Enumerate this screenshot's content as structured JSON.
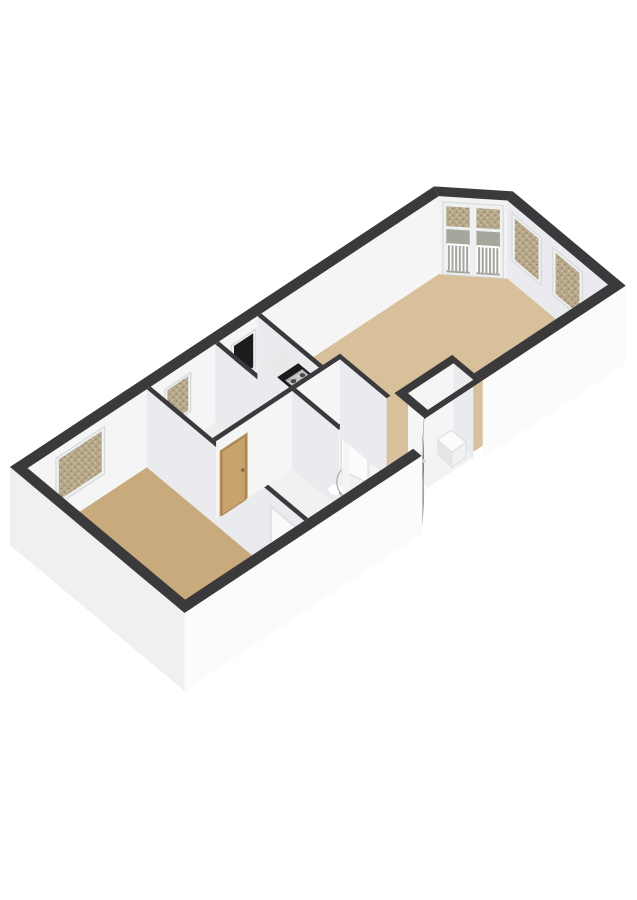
{
  "page": {
    "background_color": "#ffffff",
    "view": "3d-axonometric-floorplan"
  },
  "floorplan": {
    "wall_top_color": "#3a3a3c",
    "wall_face_colors": {
      "exterior_se": "#fbfbfc",
      "exterior_sw": "#eef0f2",
      "entrance_recess": "#f1f2f4",
      "interior_se": "#f5f5f6",
      "interior_chamfer": "#f2f2f3",
      "interior_sw": "#e9ebee"
    },
    "rooms": [
      {
        "id": "living-room-kitchen",
        "floor_color": "#d8c09b"
      },
      {
        "id": "bedroom",
        "floor_color": "#c9aa7d"
      },
      {
        "id": "bathroom",
        "floor_color": "#cdd5de"
      },
      {
        "id": "hallway",
        "floor_color": "#f2f1ef"
      },
      {
        "id": "toilet",
        "floor_color": "#f2f1ef"
      },
      {
        "id": "storage-room",
        "floor_color": "#efeeec"
      },
      {
        "id": "closet-niche",
        "floor_color": "#f3f3f3"
      }
    ],
    "windows": {
      "frame_color": "#eef0f2",
      "frame_stroke": "#d3d6d8",
      "glass_speckled_base": "#b7a88a",
      "glass_speckled_dot_dark": "#97866a",
      "glass_speckled_dot_light": "#d8ccb2",
      "glass_dark": "#1b1c1e",
      "balcony_lower_pane": "#a5a69c",
      "railing_color": "#ffffff",
      "items": [
        {
          "id": "bedroom-window",
          "glass": "speckled"
        },
        {
          "id": "storage-window",
          "glass": "speckled"
        },
        {
          "id": "bathroom-window",
          "glass": "dark"
        },
        {
          "id": "balcony-french-door",
          "glass": "speckled-over-railing"
        },
        {
          "id": "living-window-1",
          "glass": "speckled"
        },
        {
          "id": "living-window-2",
          "glass": "speckled"
        }
      ]
    },
    "doors": [
      {
        "id": "front-door",
        "color": "#9aa0a6",
        "frame_color": "#d5d8da",
        "glass_color": "#6f757b",
        "slot_color": "#cfd2d4"
      },
      {
        "id": "storage-door",
        "color": "#c9a36c",
        "frame_color": "#b68d55",
        "edge_color": "#a87f4f",
        "handle_color": "#8a6a3f"
      },
      {
        "id": "bedroom-door",
        "color": "#f9f9fa",
        "frame_color": "#e3e4e6",
        "edge_color": "#dddfe1",
        "handle_color": "#c9ccd0"
      },
      {
        "id": "toilet-door-open",
        "color": "#fcfcfd",
        "edge_color": "#d8d8d8",
        "arc_color": "#a7abaf"
      }
    ],
    "kitchen": {
      "counter_top_color": "#1b1b1d",
      "cabinet_top_color": "#e9e9ea",
      "cabinet_face_color": "#eef0f1",
      "stove_color": "#c3c5c7",
      "stove_edge_color": "#9da0a2",
      "burner_color": "#47494b"
    },
    "fixtures": [
      {
        "id": "toilet-sink",
        "color": "#ffffff",
        "stroke": "#b9bec2",
        "faucet_color": "#8b9094"
      },
      {
        "id": "boiler-unit",
        "face_color": "#f0f1f2",
        "side_color": "#e4e6e8",
        "top_color": "#fafbfb",
        "stroke": "#dadcdd"
      },
      {
        "id": "bedroom-threshold",
        "color": "#fcfcfd"
      }
    ]
  }
}
